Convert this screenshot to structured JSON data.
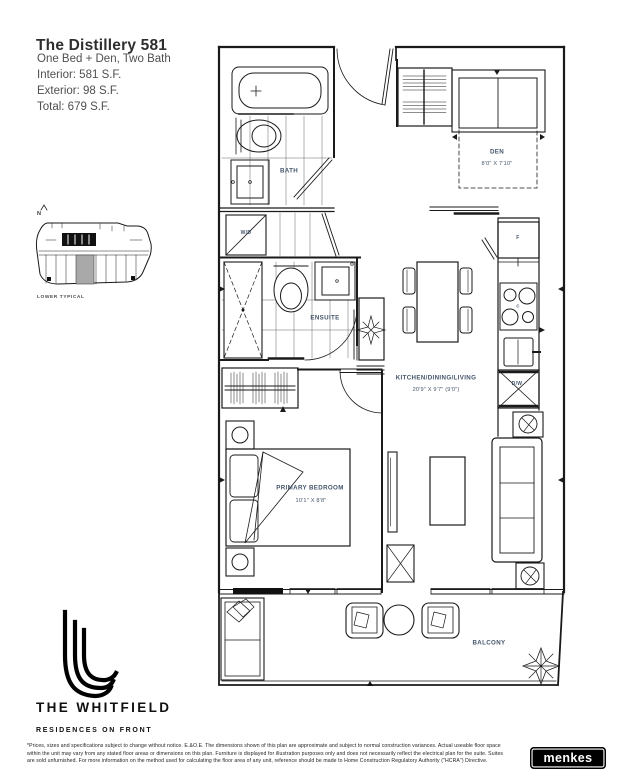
{
  "header": {
    "title": "The Distillery 581",
    "subtitle": "One Bed + Den, Two Bath",
    "interior": "Interior: 581 S.F.",
    "exterior": "Exterior: 98 S.F.",
    "total": "Total: 679 S.F."
  },
  "keyplan": {
    "north": "N",
    "caption": "LOWER TYPICAL"
  },
  "plan": {
    "labels": {
      "bath": "BATH",
      "wd": "W/D",
      "den": "DEN",
      "den_dims": "8'0\" X 7'10\"",
      "ensuite": "ENSUITE",
      "kitchen": "KITCHEN/DINING/LIVING",
      "kitchen_dims": "20'9\" X 9'7\" (9'0\")",
      "bedroom": "PRIMARY BEDROOM",
      "bedroom_dims": "10'1\" X 8'8\"",
      "balcony": "BALCONY",
      "fridge": "F",
      "cooktop": "C",
      "dishwasher": "D/W"
    },
    "colors": {
      "label_text": "#44546a",
      "line": "#1a1a1a",
      "highlight_unit": "#a9a9a9"
    }
  },
  "footer": {
    "brand": "THE WHITFIELD",
    "brand_sub": "RESIDENCES ON FRONT",
    "disclaimer_lines": [
      "*Prices, sizes and specifications subject to change without notice. E.&O.E. The dimensions shown of this plan are approximate and subject to normal construction variances. Actual useable floor space",
      "within the unit may vary from any stated floor areas or dimensions on this plan. Furniture is displayed for illustration purposes only and does not necessarily reflect the electrical plan for the suite. Suites",
      "are sold unfurnished. For more information on the method used for calculating the floor area of any unit, reference should be made to Home Construction Regulatory Authority (\"HCRA\") Directive."
    ],
    "developer": "menkes"
  }
}
